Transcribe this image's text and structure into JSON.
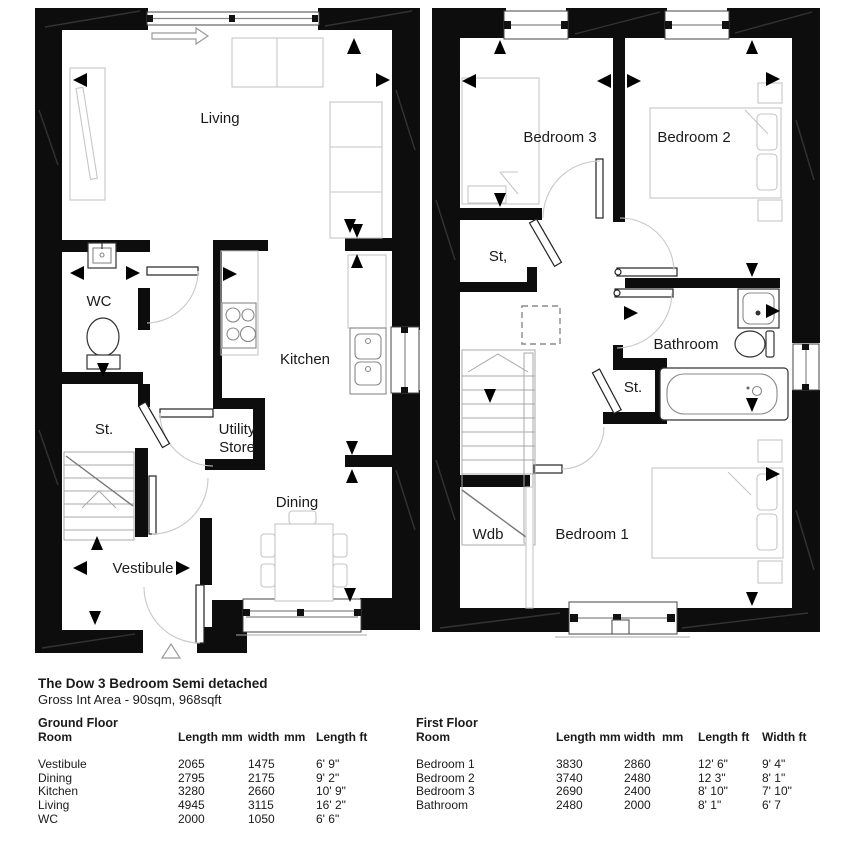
{
  "header": {
    "title": "The Dow 3 Bedroom Semi detached",
    "subtitle": "Gross Int Area - 90sqm, 968sqft"
  },
  "plans": {
    "ground": {
      "labels": {
        "living": "Living",
        "wc": "WC",
        "kitchen": "Kitchen",
        "utility_line1": "Utility",
        "utility_line2": "Store",
        "st": "St.",
        "dining": "Dining",
        "vestibule": "Vestibule"
      }
    },
    "first": {
      "labels": {
        "bedroom3": "Bedroom 3",
        "bedroom2": "Bedroom 2",
        "st_upper": "St,",
        "bathroom": "Bathroom",
        "st_lower": "St.",
        "wdb": "Wdb",
        "bedroom1": "Bedroom 1"
      }
    }
  },
  "tables": {
    "ground": {
      "title": "Ground Floor",
      "headers": {
        "room": "Room",
        "length_mm": "Length mm",
        "width": "width",
        "mm": "mm",
        "length_ft": "Length ft"
      },
      "rows": [
        {
          "room": "Vestibule",
          "length_mm": "2065",
          "width_mm": "1475",
          "length_ft": "6' 9\""
        },
        {
          "room": "Dining",
          "length_mm": "2795",
          "width_mm": "2175",
          "length_ft": "9' 2\""
        },
        {
          "room": "Kitchen",
          "length_mm": "3280",
          "width_mm": "2660",
          "length_ft": "10' 9\""
        },
        {
          "room": "Living",
          "length_mm": "4945",
          "width_mm": "3115",
          "length_ft": "16' 2\""
        },
        {
          "room": "WC",
          "length_mm": "2000",
          "width_mm": "1050",
          "length_ft": "6' 6\""
        }
      ]
    },
    "first": {
      "title": "First Floor",
      "headers": {
        "room": "Room",
        "length_mm": "Length mm",
        "width": "width",
        "mm": "mm",
        "length_ft": "Length ft",
        "width_ft": "Width ft"
      },
      "rows": [
        {
          "room": "Bedroom 1",
          "length_mm": "3830",
          "width_mm": "2860",
          "length_ft": "12' 6\"",
          "width_ft": "9' 4\""
        },
        {
          "room": "Bedroom 2",
          "length_mm": "3740",
          "width_mm": "2480",
          "length_ft": "12 3\"",
          "width_ft": "8' 1\""
        },
        {
          "room": "Bedroom 3",
          "length_mm": "2690",
          "width_mm": "2400",
          "length_ft": "8' 10\"",
          "width_ft": "7' 10\""
        },
        {
          "room": "Bathroom",
          "length_mm": "2480",
          "width_mm": "2000",
          "length_ft": "8' 1\"",
          "width_ft": "6' 7"
        }
      ]
    }
  },
  "colors": {
    "wall": "#0d0d0d",
    "furniture_outline": "#c6c6c6",
    "label": "#1a1a1a"
  }
}
